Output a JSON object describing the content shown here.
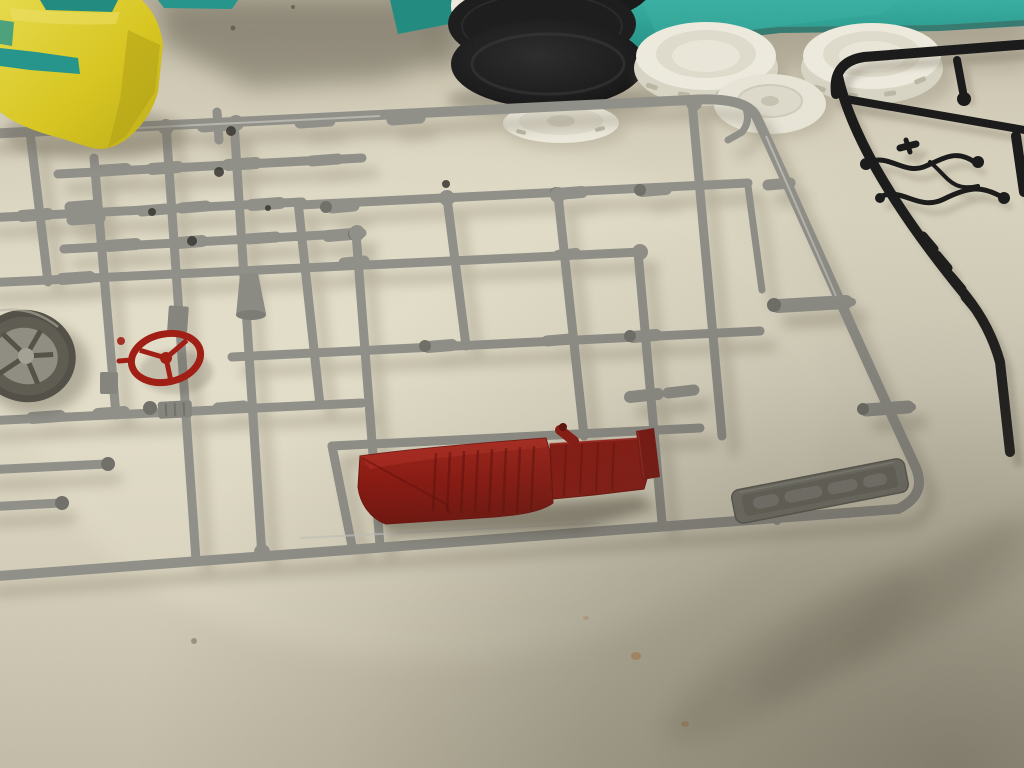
{
  "meta": {
    "type": "photograph",
    "subject": "Plastic scale-model kit sprues and parts laid out on a cream table",
    "width_px": 1024,
    "height_px": 768
  },
  "palette": {
    "table_light": "#e2ddc8",
    "table_mid": "#d5cfba",
    "table_edge": "#b6b09c",
    "cast_shadow": "#8b8471",
    "deep_shadow": "#4a4337",
    "sprue_silver": "#8f8f88",
    "sprue_light": "#c6c6bf",
    "sprue_dark": "#6f6f68",
    "red": "#a01b11",
    "red_dark": "#6f0f09",
    "red_light": "#c5362a",
    "seat_red": "#8c150d",
    "yellow": "#d8c61e",
    "yellow_light": "#e7da48",
    "yellow_dark": "#b0a013",
    "teal": "#2aa093",
    "teal_dark": "#1f8a7f",
    "tire_black": "#191919",
    "white_part": "#eeebde",
    "white_dim": "#d9d5c5",
    "white_dark": "#bcb7a4",
    "black_sprue": "#171717",
    "wheel_tire": "#514e45",
    "wheel_hub": "#8f8c80",
    "stain_orange": "#c8803c"
  },
  "objects": [
    {
      "id": "table-surface",
      "label": "Cream laminate table surface with faint orange stains"
    },
    {
      "id": "silver-sprue",
      "label": "Large silver model-kit sprue with exhaust, axle and engine parts"
    },
    {
      "id": "steering-wheel",
      "label": "Red three-spoke steering wheel part"
    },
    {
      "id": "bench-seat",
      "label": "Dark red ribbed bench seat part"
    },
    {
      "id": "brand-tag",
      "label": "Embossed manufacturer tag on sprue corner"
    },
    {
      "id": "black-sprue",
      "label": "Black model-kit sprue with wiring and lever parts"
    },
    {
      "id": "tire-stack",
      "label": "Stack of black rubber tires with white wheel"
    },
    {
      "id": "white-lid-left",
      "label": "White slotted wheel ring, left"
    },
    {
      "id": "white-lid-right",
      "label": "White slotted wheel ring, right"
    },
    {
      "id": "white-hub-disc",
      "label": "White hub disc under sprue corner"
    },
    {
      "id": "white-wheel-disc",
      "label": "Flat white wheel back on table"
    },
    {
      "id": "yellow-masked-body",
      "label": "Model body masked with yellow tape over teal paint"
    },
    {
      "id": "teal-storage-box",
      "label": "Teal storage box along top edge"
    },
    {
      "id": "silver-wheel",
      "label": "Silver wheel with tire at left edge"
    },
    {
      "id": "hand-shadow",
      "label": "Soft shadow falling across bottom-right corner"
    },
    {
      "id": "red-trim-strip",
      "label": "Small dark red trim strip part"
    },
    {
      "id": "exhaust-parts",
      "label": "Bullet-tipped exhaust pipe parts"
    }
  ]
}
